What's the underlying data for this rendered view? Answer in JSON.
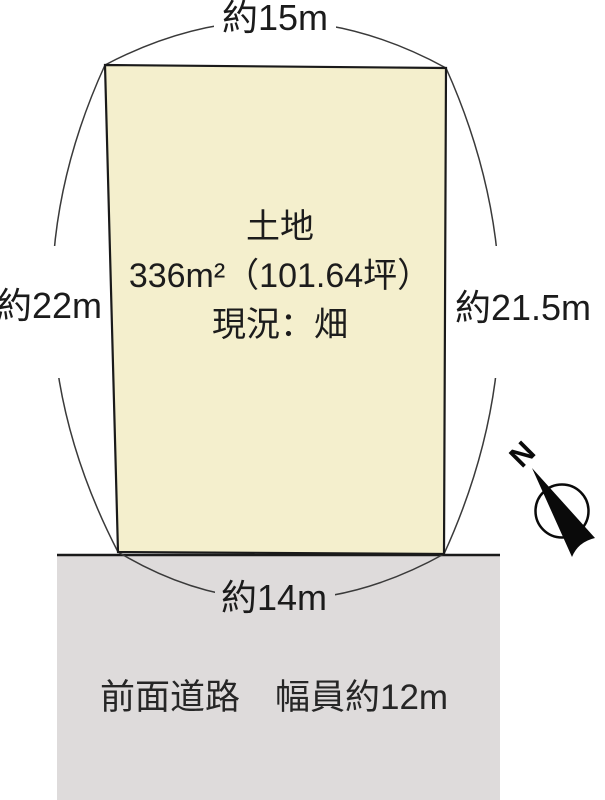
{
  "diagram": {
    "parcel": {
      "title": "土地",
      "area": "336m²（101.64坪）",
      "status": "現況：畑",
      "fill_color": "#f4efcd",
      "border_color": "#1a1a1a"
    },
    "dimensions": {
      "top": "約15m",
      "left": "約22m",
      "right": "約21.5m",
      "bottom": "約14m"
    },
    "road": {
      "label": "前面道路　幅員約12m",
      "fill_color": "#dedbdb"
    },
    "compass": {
      "north_label": "N"
    }
  }
}
